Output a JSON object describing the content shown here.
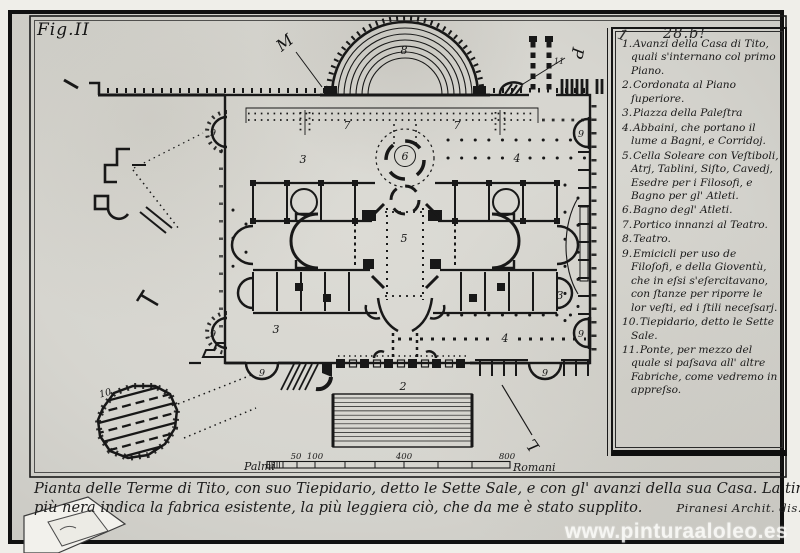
{
  "plate": {
    "fig_label": "Fig.II",
    "plate_number": "28.b!",
    "pen_mark": "1"
  },
  "legend": {
    "items": [
      {
        "num": "1.",
        "text": "Avanzi della Casa di Tito, quali s'internano col primo Piano."
      },
      {
        "num": "2.",
        "text": "Cordonata al Piano ſuperiore."
      },
      {
        "num": "3.",
        "text": "Piazza della Paleſtra"
      },
      {
        "num": "4.",
        "text": "Abbaini, che portano il lume a Bagni, e Corridoj."
      },
      {
        "num": "5.",
        "text": "Cella Soleare con Veſtiboli, Atrj, Tablini, Siſto, Cavedj, Esedre per i Filosofi, e Bagno per gl' Atleti."
      },
      {
        "num": "6.",
        "text": "Bagno degl' Atleti."
      },
      {
        "num": "7.",
        "text": "Portico innanzi al Teatro."
      },
      {
        "num": "8.",
        "text": "Teatro."
      },
      {
        "num": "9.",
        "text": "Emicicli per uso de Filoſofi, e della Gioventù, che in eſsi s'eſercitavano, con ſtanze per riporre le lor veſti, ed i ſtili neceſsarj."
      },
      {
        "num": "10.",
        "text": "Tiepidario, detto le Sette Sale."
      },
      {
        "num": "11.",
        "text": "Ponte, per mezzo del quale si paſsava all' altre Fabriche, come vedremo in appreſso."
      }
    ]
  },
  "caption": {
    "line1": "Pianta delle Terme di Tito, con suo Tiepidario, detto le Sette Sale, e con gl' avanzi della sua Casa. La tinta",
    "line2": "più nera indica la fabrica esistente, la più leggiera ciò, che da me è stato supplito.",
    "signature": "Piranesi Archit. dis. inc."
  },
  "scale_bar": {
    "left_label": "Palmi",
    "right_label": "Romani",
    "ticks": [
      "50",
      "100",
      "400",
      "800"
    ]
  },
  "plan_labels": {
    "stairs": "2",
    "palestra": "3",
    "colonnade": "4",
    "great_hall": "5",
    "vestibule": "6",
    "portico": "7",
    "theater": "8",
    "hemicycle": "9",
    "tepidarium": "10",
    "bridge": "11",
    "letter_m": "M",
    "letter_p": "P",
    "letter_l": "L"
  },
  "watermark": "www.pinturaaloleo.es",
  "colors": {
    "paper": "#d7d6d0",
    "ink": "#181818",
    "margin": "#efeee9"
  }
}
